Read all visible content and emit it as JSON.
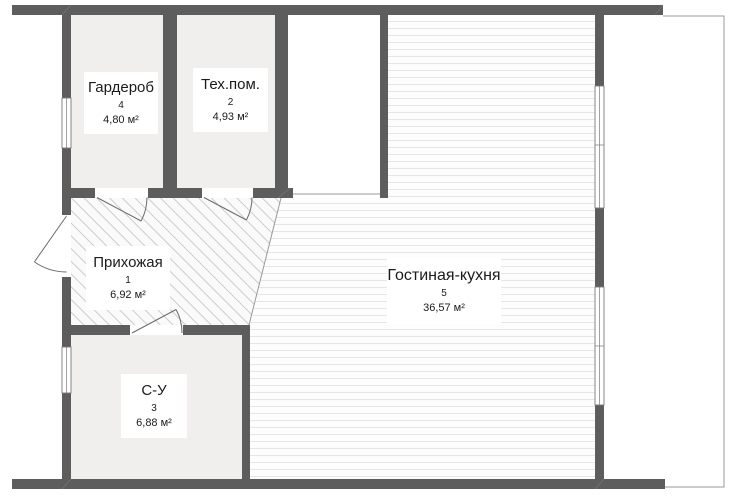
{
  "plan": {
    "title": "apartment-floor-plan",
    "rooms": [
      {
        "name": "Гардероб",
        "number": "4",
        "area": "4,80 м²"
      },
      {
        "name": "Тех.пом.",
        "number": "2",
        "area": "4,93 м²"
      },
      {
        "name": "Прихожая",
        "number": "1",
        "area": "6,92 м²"
      },
      {
        "name": "С-У",
        "number": "3",
        "area": "6,88 м²"
      },
      {
        "name": "Гостиная-кухня",
        "number": "5",
        "area": "36,57 м²"
      }
    ],
    "colors": {
      "wall": "#5d5d5d",
      "room_fill": "#f0efee",
      "hatch_line": "#cccccc",
      "hatch_bg": "#fafafa",
      "stripe_line": "#e6e6e6",
      "stripe_bg": "#fdfdfd",
      "thin": "#9a9a9a",
      "door": "#6a6a6a",
      "window_frame": "#7a7a7a",
      "text": "#1b1b1b"
    }
  }
}
